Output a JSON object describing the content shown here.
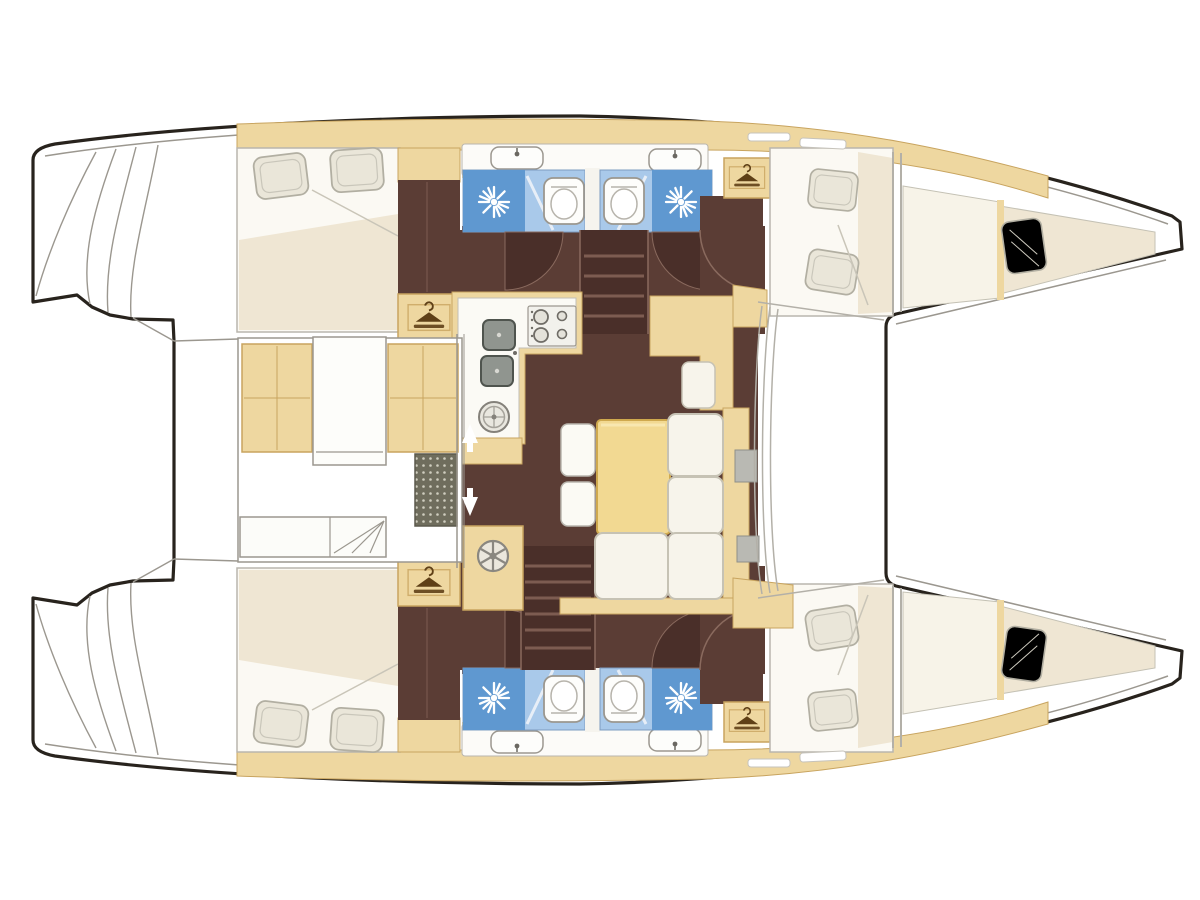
{
  "meta": {
    "title": "Catamaran accommodation floor plan",
    "type": "boat-floor-plan",
    "view": "top-down deck plan",
    "orientation": "bow-right, stern-left",
    "hull_count": 2
  },
  "palette": {
    "paper": "#ffffff",
    "outline": "#28231d",
    "line": "#9b978f",
    "tan": "#eed7a0",
    "tan_border": "#c8a45f",
    "tan_icon": "#5f4017",
    "brown": "#5b3d35",
    "brown_dark": "#4a2f29",
    "step_line": "#7d5c51",
    "bed_white": "#fbf9f3",
    "cream": "#efe6d3",
    "pillow": "#eae6d9",
    "pillow_border": "#b2afa2",
    "blue_light": "#a9c9ea",
    "blue_deep": "#5f98d0",
    "sofa": "#f7f4eb",
    "sofa_border": "#c6c2b4",
    "table_yellow": "#f2d992",
    "table_border": "#cfa94e",
    "white_fixture": "#fdfdfb",
    "fixture_border": "#9b978f",
    "sink_gray": "#90958f",
    "metal_gray": "#b9b9b3",
    "grate": "#6f6d5d",
    "grate_dot": "#cfcdbf"
  },
  "rooms": {
    "foredeck": {
      "name": "Foredeck between bows"
    },
    "cockpit": {
      "name": "Aft cockpit",
      "fixtures": [
        "bench seats with cushions",
        "cockpit table",
        "deck grate",
        "sliding door to salon",
        "transom steps"
      ]
    },
    "salon": {
      "name": "Salon dinette",
      "fixtures": [
        "dinette table",
        "L-shaped sofa",
        "two stools",
        "navigation seat",
        "front windshield"
      ]
    },
    "galley": {
      "name": "Galley",
      "fixtures": [
        "four-burner stove",
        "twin square sinks",
        "round basin",
        "L-shaped counter"
      ]
    },
    "port_hull": {
      "name": "Port hull (top)",
      "cabins": [
        "aft double cabin",
        "forward double cabin",
        "bow berth"
      ],
      "heads": 2,
      "wardrobes": 2,
      "companionway": "stairs down into hull"
    },
    "starboard_hull": {
      "name": "Starboard hull (bottom)",
      "cabins": [
        "aft double cabin",
        "forward double cabin",
        "bow berth"
      ],
      "heads": 2,
      "wardrobes": 2,
      "companionway": "stairs down into hull"
    }
  },
  "heads_detail": {
    "per_head_fixtures": [
      "shower with rose",
      "toilet",
      "washbasin"
    ],
    "floor_color_key": "blue_light"
  },
  "icons": {
    "hanger-icon": "wardrobe locker",
    "shower-burst-icon": "shower rose",
    "toilet-icon": "toilet",
    "basin-icon": "washbasin with faucet",
    "stove-icon": "four-burner hob",
    "square-sink-icon": "galley sink",
    "round-sink-icon": "round basin",
    "spoked-wheel-icon": "round hatch fixture",
    "door-arrow-icon": "sliding door direction arrows",
    "grate-icon": "cockpit deck grate",
    "door-swing-icon": "door swing arc"
  },
  "counts": {
    "double_cabins": 4,
    "bow_berths": 2,
    "heads": 4,
    "toilets": 4,
    "showers": 4,
    "washbasins": 4,
    "wardrobes": 4,
    "companionway_stairs": 2,
    "door_swings": 6,
    "pillows": 10
  }
}
